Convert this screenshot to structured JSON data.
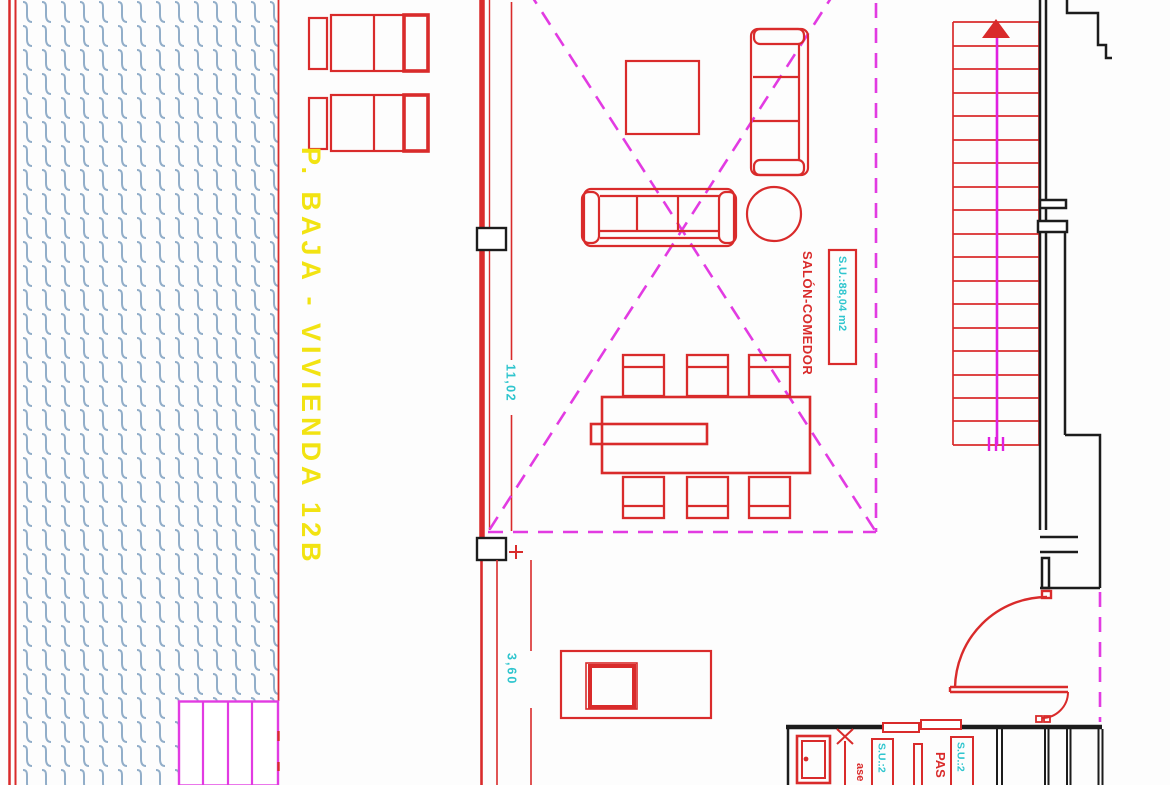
{
  "drawing": {
    "floor_title": "P. BAJA - VIVIENDA 12B",
    "rooms": {
      "salon_comedor": {
        "label": "SALÓN-COMEDOR",
        "area": "S.U.:88,04 m2"
      },
      "aseo": {
        "label": "ase",
        "area": "S.U.:2"
      },
      "pasillo": {
        "label": "PAS",
        "area": "S.U.:2"
      }
    },
    "dimensions": {
      "salon_depth": "11,02",
      "opening_width": "3,60"
    }
  },
  "colors": {
    "wall_red": "#d92b2b",
    "dashed_magenta": "#e23be2",
    "stair_magenta": "#e020e0",
    "title_yellow": "#f2e312",
    "dim_cyan": "#2fc5ce",
    "hatch_blue": "#92aec9",
    "wall_black": "#1c1c1c",
    "background": "#fdfdfd"
  }
}
